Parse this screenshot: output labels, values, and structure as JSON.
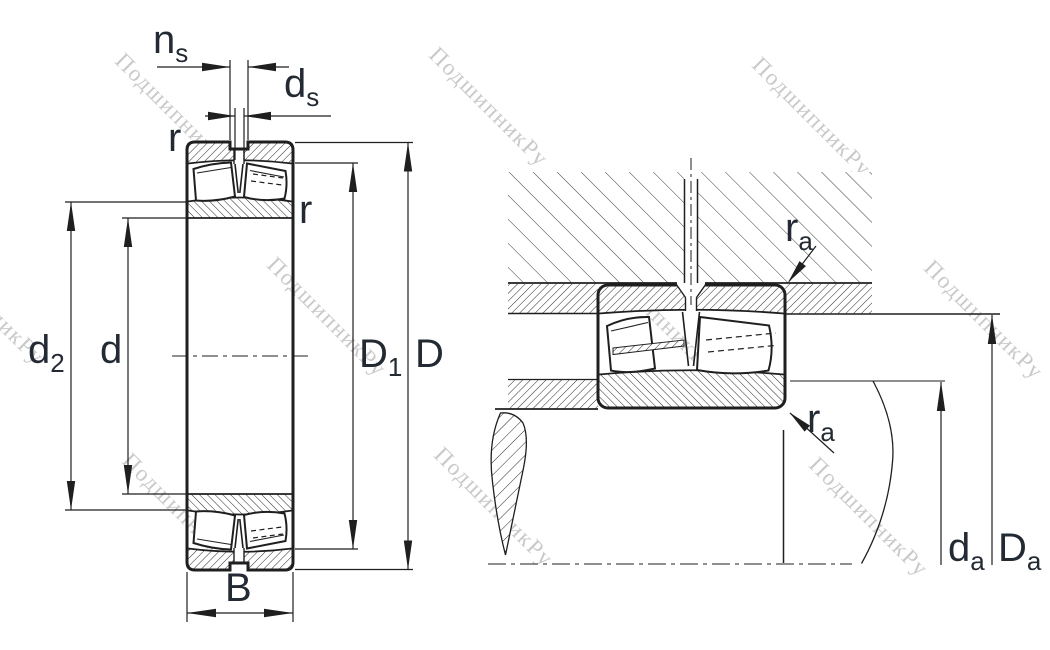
{
  "watermark": {
    "text": "ПодшипникРу",
    "color": "#c9c9c9"
  },
  "colors": {
    "line": "#1f1f1f",
    "label": "#232a33",
    "hatch": "#2a2a2a",
    "housing_hatch": "#3f3f3f"
  },
  "views": {
    "left": {
      "labels": {
        "ns": {
          "main": "n",
          "sub": "s"
        },
        "ds": {
          "main": "d",
          "sub": "s"
        },
        "r_outer": {
          "main": "r",
          "sub": ""
        },
        "r_inner": {
          "main": "r",
          "sub": ""
        },
        "d2": {
          "main": "d",
          "sub": "2"
        },
        "d": {
          "main": "d",
          "sub": ""
        },
        "D1": {
          "main": "D",
          "sub": "1"
        },
        "D": {
          "main": "D",
          "sub": ""
        },
        "B": {
          "main": "B",
          "sub": ""
        }
      }
    },
    "right": {
      "labels": {
        "ra_housing": {
          "main": "r",
          "sub": "a"
        },
        "ra_shaft": {
          "main": "r",
          "sub": "a"
        },
        "da": {
          "main": "d",
          "sub": "a"
        },
        "Da": {
          "main": "D",
          "sub": "a"
        }
      }
    }
  }
}
